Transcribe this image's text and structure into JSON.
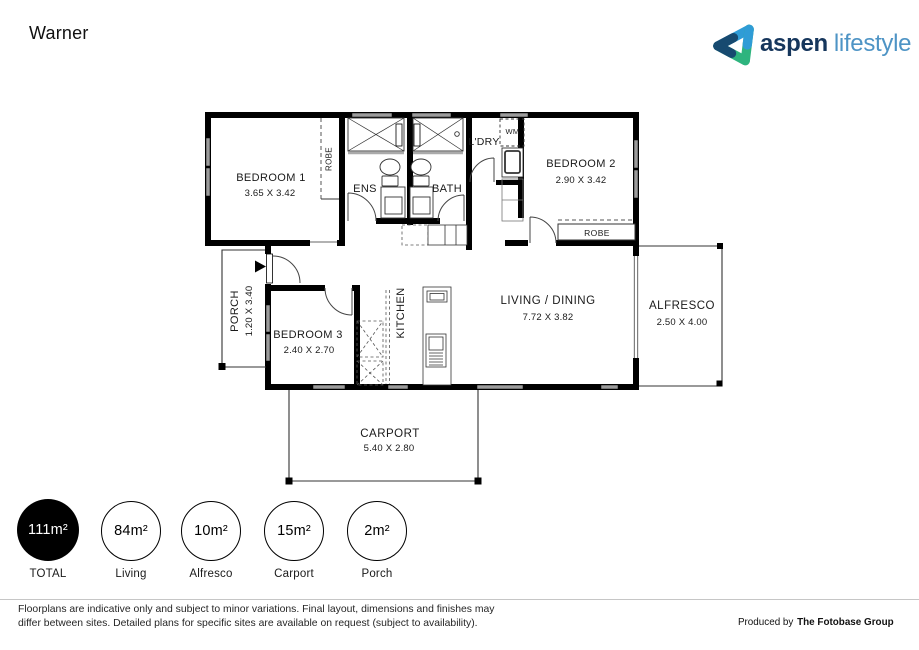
{
  "header": {
    "title": "Warner"
  },
  "logo": {
    "brand": "aspen",
    "suffix": "lifestyle"
  },
  "colors": {
    "brand_navy": "#16365c",
    "brand_light_blue": "#2f9cd6",
    "brand_green": "#2eb47e",
    "brand_text_blue": "#4e94c5"
  },
  "floorplan": {
    "bedroom1": {
      "name": "BEDROOM 1",
      "dims": "3.65 X 3.42"
    },
    "bedroom1_robe": {
      "name": "ROBE"
    },
    "ens": {
      "name": "ENS"
    },
    "bath": {
      "name": "BATH"
    },
    "ldry": {
      "name": "L'DRY"
    },
    "wm": {
      "name": "WM"
    },
    "bedroom2": {
      "name": "BEDROOM 2",
      "dims": "2.90 X 3.42"
    },
    "bedroom2_robe": {
      "name": "ROBE"
    },
    "porch": {
      "name": "PORCH",
      "dims": "1.20 X 3.40"
    },
    "bedroom3": {
      "name": "BEDROOM 3",
      "dims": "2.40 X 2.70"
    },
    "kitchen": {
      "name": "KITCHEN"
    },
    "living": {
      "name": "LIVING / DINING",
      "dims": "7.72 X 3.82"
    },
    "alfresco": {
      "name": "ALFRESCO",
      "dims": "2.50 X 4.00"
    },
    "carport": {
      "name": "CARPORT",
      "dims": "5.40 X 2.80"
    }
  },
  "areas": [
    {
      "value": "111m²",
      "label": "TOTAL"
    },
    {
      "value": "84m²",
      "label": "Living"
    },
    {
      "value": "10m²",
      "label": "Alfresco"
    },
    {
      "value": "15m²",
      "label": "Carport"
    },
    {
      "value": "2m²",
      "label": "Porch"
    }
  ],
  "footer": {
    "disclaimer_line1": "Floorplans are indicative only and subject to minor variations. Final layout, dimensions and finishes may",
    "disclaimer_line2": "differ between sites. Detailed plans for specific sites are available on request (subject to availability).",
    "produced_by": "Produced by",
    "producer": "The Fotobase Group"
  }
}
